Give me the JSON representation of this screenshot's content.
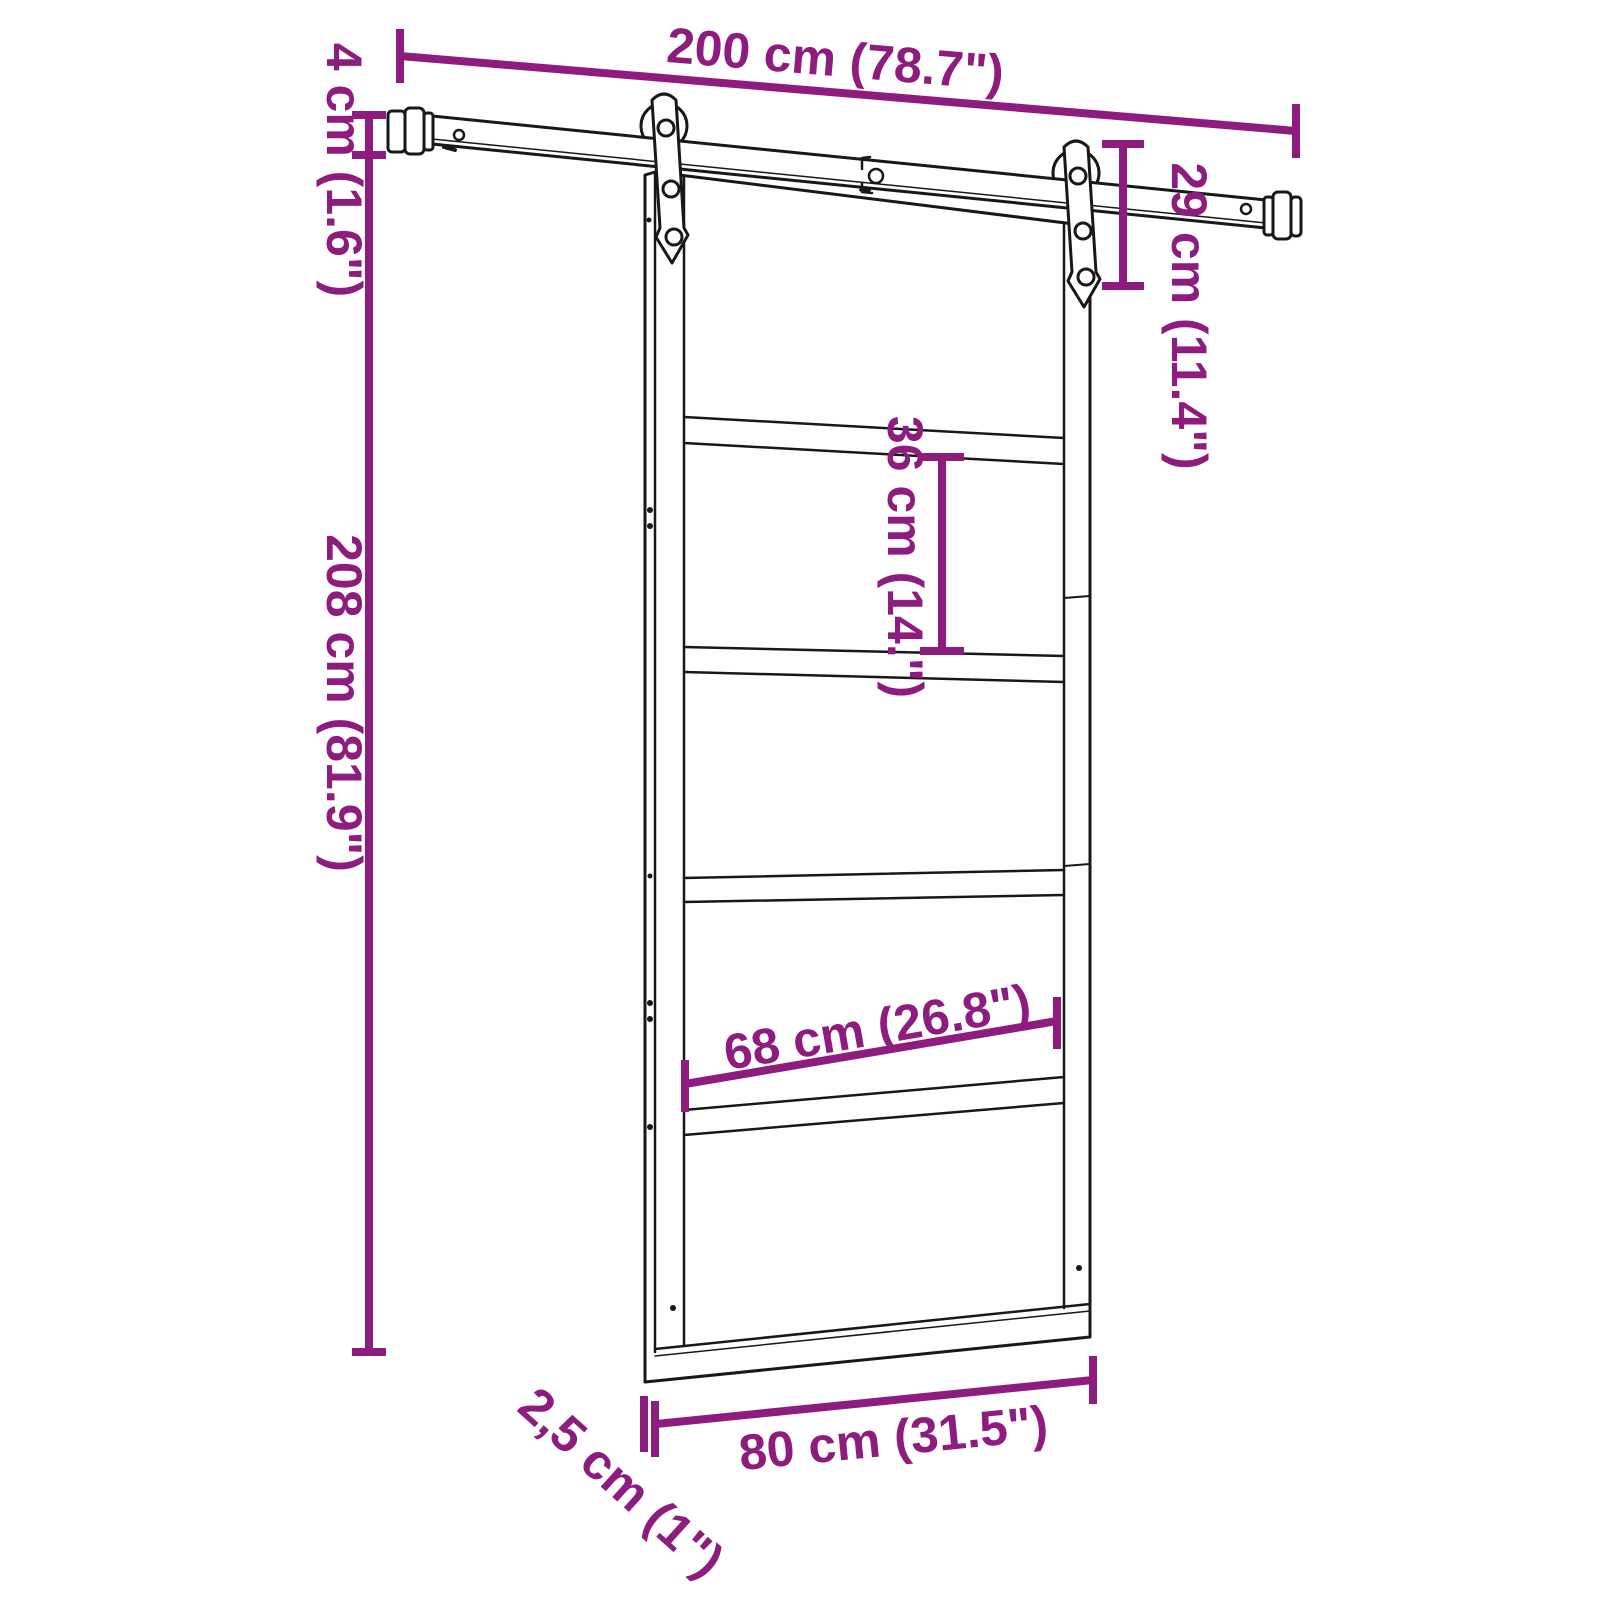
{
  "diagram": {
    "subject": "Sliding barn door with overhead hanging rail hardware - dimension drawing",
    "background": "#ffffff",
    "accent_color": "#8e1c7e",
    "line_color": "#181818",
    "dimensions": {
      "track_length": {
        "label": "200 cm (78.7\")"
      },
      "rail_height": {
        "label": "4 cm (1.6\")"
      },
      "door_height": {
        "label": "208 cm (81.9\")"
      },
      "hanger_height": {
        "label": "29 cm (11.4\")"
      },
      "panel_height": {
        "label": "36 cm (14.\")"
      },
      "panel_width": {
        "label": "68 cm (26.8\")"
      },
      "door_width": {
        "label": "80 cm (31.5\")"
      },
      "door_thickness": {
        "label": "2,5 cm (1\")"
      }
    }
  }
}
